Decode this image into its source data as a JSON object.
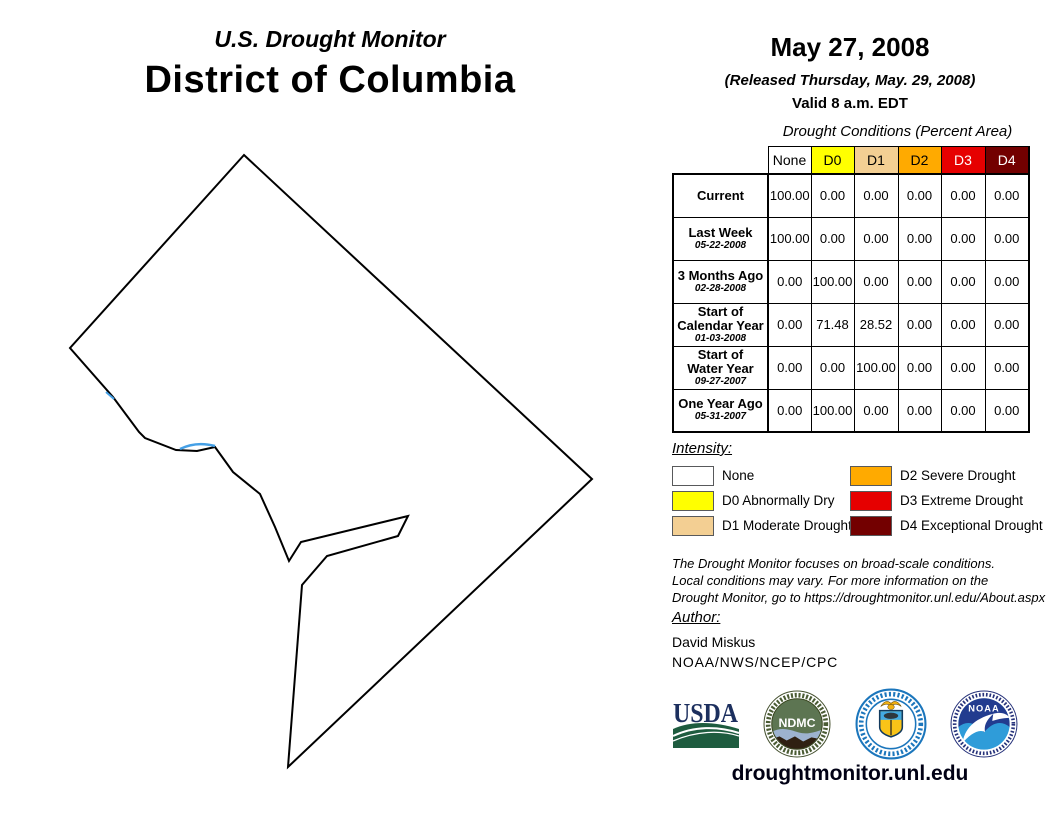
{
  "header": {
    "monitor_title": "U.S. Drought Monitor",
    "region_title": "District of Columbia",
    "date": "May 27, 2008",
    "released": "(Released Thursday, May. 29, 2008)",
    "valid": "Valid 8 a.m. EDT"
  },
  "table": {
    "title": "Drought Conditions (Percent Area)",
    "columns": [
      "None",
      "D0",
      "D1",
      "D2",
      "D3",
      "D4"
    ],
    "column_colors": [
      "#FFFFFF",
      "#FFFF00",
      "#F3CF93",
      "#FFAA00",
      "#E60000",
      "#730000"
    ],
    "column_text_colors": [
      "#000000",
      "#000000",
      "#000000",
      "#000000",
      "#FFFFFF",
      "#FFFFFF"
    ],
    "rows": [
      {
        "label_lines": [
          "Current"
        ],
        "date": "",
        "values": [
          "100.00",
          "0.00",
          "0.00",
          "0.00",
          "0.00",
          "0.00"
        ]
      },
      {
        "label_lines": [
          "Last Week"
        ],
        "date": "05-22-2008",
        "values": [
          "100.00",
          "0.00",
          "0.00",
          "0.00",
          "0.00",
          "0.00"
        ]
      },
      {
        "label_lines": [
          "3 Months Ago"
        ],
        "date": "02-28-2008",
        "values": [
          "0.00",
          "100.00",
          "0.00",
          "0.00",
          "0.00",
          "0.00"
        ]
      },
      {
        "label_lines": [
          "Start of",
          "Calendar Year"
        ],
        "date": "01-03-2008",
        "values": [
          "0.00",
          "71.48",
          "28.52",
          "0.00",
          "0.00",
          "0.00"
        ]
      },
      {
        "label_lines": [
          "Start of",
          "Water Year"
        ],
        "date": "09-27-2007",
        "values": [
          "0.00",
          "0.00",
          "100.00",
          "0.00",
          "0.00",
          "0.00"
        ]
      },
      {
        "label_lines": [
          "One Year Ago"
        ],
        "date": "05-31-2007",
        "values": [
          "0.00",
          "100.00",
          "0.00",
          "0.00",
          "0.00",
          "0.00"
        ]
      }
    ]
  },
  "legend": {
    "title": "Intensity:",
    "items": [
      {
        "code": "none",
        "label": "None",
        "color": "#FFFFFF"
      },
      {
        "code": "D0",
        "label": "D0 Abnormally Dry",
        "color": "#FFFF00"
      },
      {
        "code": "D1",
        "label": "D1 Moderate Drought",
        "color": "#F3CF93"
      },
      {
        "code": "D2",
        "label": "D2 Severe Drought",
        "color": "#FFAA00"
      },
      {
        "code": "D3",
        "label": "D3 Extreme Drought",
        "color": "#E60000"
      },
      {
        "code": "D4",
        "label": "D4 Exceptional Drought",
        "color": "#730000"
      }
    ]
  },
  "disclaimer": {
    "lines": [
      "The Drought Monitor focuses on broad-scale conditions.",
      "Local conditions may vary. For more information on the",
      "Drought Monitor, go to https://droughtmonitor.unl.edu/About.aspx"
    ]
  },
  "author": {
    "title": "Author:",
    "name": "David Miskus",
    "org": "NOAA/NWS/NCEP/CPC"
  },
  "logos": {
    "usda_label": "USDA",
    "ndmc_label": "NDMC",
    "noaa_label": "NOAA"
  },
  "footer": {
    "url": "droughtmonitor.unl.edu"
  },
  "map": {
    "fill": "#FFFFFF",
    "outline": "#000000",
    "water": "#45A0E6"
  }
}
